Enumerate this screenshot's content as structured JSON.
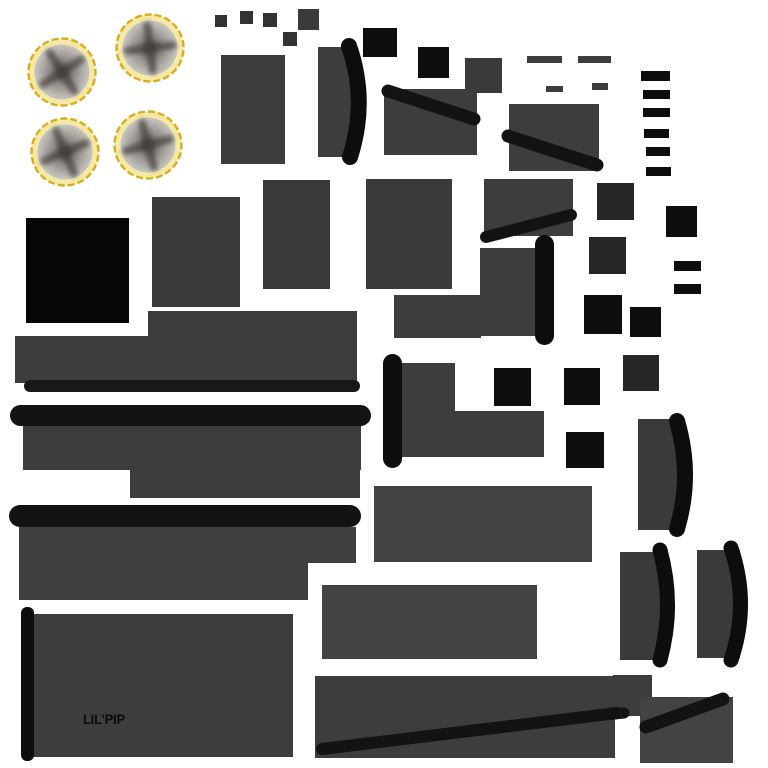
{
  "canvas": {
    "background": "#ffffff"
  },
  "label": {
    "text": "LIL'PIP"
  },
  "palette": {
    "white": "#ffffff",
    "gray_sq": "#333333",
    "gray_dark": "#3a3a3a",
    "gray_mid": "#3d3d3d",
    "gray_light": "#434343",
    "gray_row": "#3f3f3f",
    "gray_deep": "#262626",
    "black": "#0d0d0d",
    "pure_black": "#060606",
    "ink": "#131313",
    "ink_soft": "#181818",
    "label_ink": "#0b0b0b",
    "ring_gold": "#d9ad1f",
    "ring_fill": "#f5e9a6",
    "disc_edge": "#c9c6c2",
    "disc_mid": "#96918c",
    "disc_center": "#5a534d",
    "blade": "#453f3a"
  },
  "icons": {
    "fan_disc": "radial-fan-blade-disc"
  }
}
